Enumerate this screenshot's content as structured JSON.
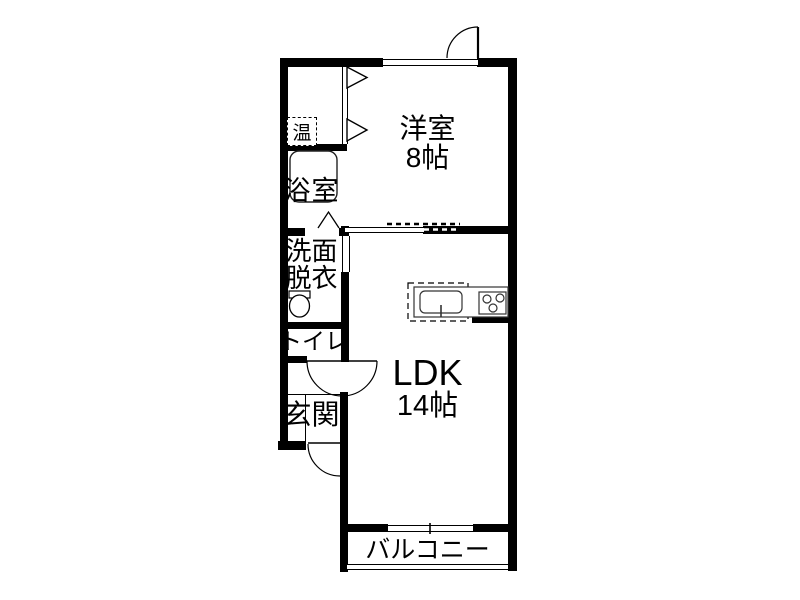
{
  "floorplan": {
    "rooms": {
      "western_room": {
        "label": "洋室",
        "size": "8帖"
      },
      "ldk": {
        "label": "LDK",
        "size": "14帖"
      },
      "balcony": {
        "label": "バルコニー"
      },
      "bathroom": {
        "label": "浴室"
      },
      "washroom": {
        "label_line1": "洗面",
        "label_line2": "脱衣"
      },
      "toilet": {
        "label": "トイレ"
      },
      "entrance": {
        "label": "玄関"
      },
      "water_heater": {
        "label": "温"
      }
    },
    "colors": {
      "wall": "#000000",
      "background": "#ffffff",
      "line": "#000000"
    }
  }
}
